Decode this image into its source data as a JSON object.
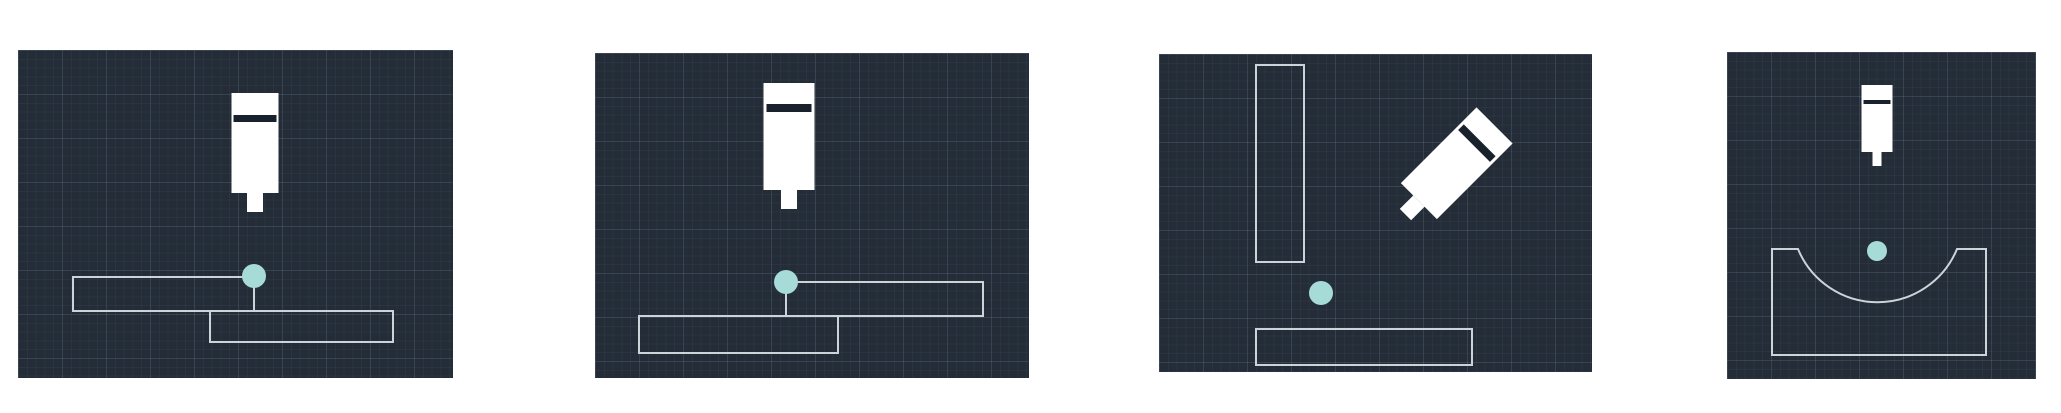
{
  "page": {
    "background": "#ffffff",
    "description_tag": "weld-scenario-thumbnails"
  },
  "theme": {
    "panel_bg": "#232c37",
    "grid_minor": "rgba(148,170,197,0.06)",
    "grid_major": "rgba(148,170,197,0.13)",
    "grid_minor_step": 8.8,
    "grid_major_step": 44,
    "outline": "#ccd3d9",
    "outline_width": 2,
    "dot_fill": "#a6dbd8",
    "torch_fill": "#ffffff",
    "torch_band": "#19222c"
  },
  "panels": [
    {
      "name": "lap-joint-upper-left",
      "x": 18,
      "y": 50,
      "w": 435,
      "h": 328,
      "torch": {
        "cx": 237,
        "top": 43,
        "body_w": 47,
        "body_h": 100,
        "band_offset": 22,
        "band_h": 7,
        "band_inset": 2,
        "stem_w": 16,
        "stem_h": 19,
        "rotation": 0
      },
      "dot": {
        "cx": 236,
        "cy": 226,
        "r": 12
      },
      "shapes": [
        {
          "type": "rect",
          "x": 55,
          "y": 227,
          "w": 181,
          "h": 34
        },
        {
          "type": "rect",
          "x": 192,
          "y": 261,
          "w": 183,
          "h": 31
        }
      ]
    },
    {
      "name": "lap-joint-upper-right",
      "x": 595,
      "y": 53,
      "w": 434,
      "h": 325,
      "torch": {
        "cx": 194,
        "top": 30,
        "body_w": 51,
        "body_h": 107,
        "band_offset": 21,
        "band_h": 8,
        "band_inset": 3,
        "stem_w": 16,
        "stem_h": 19,
        "rotation": 0
      },
      "dot": {
        "cx": 191,
        "cy": 229,
        "r": 12
      },
      "shapes": [
        {
          "type": "rect",
          "x": 191,
          "y": 229,
          "w": 197,
          "h": 34
        },
        {
          "type": "rect",
          "x": 44,
          "y": 263,
          "w": 199,
          "h": 37
        }
      ]
    },
    {
      "name": "corner-joint-angled-torch",
      "x": 1159,
      "y": 54,
      "w": 433,
      "h": 318,
      "torch": {
        "cx": 291,
        "top": 53,
        "body_w": 51,
        "body_h": 107,
        "band_offset": 21,
        "band_h": 8,
        "band_inset": 3,
        "stem_w": 16,
        "stem_h": 19,
        "rotation": 45
      },
      "dot": {
        "cx": 162,
        "cy": 239,
        "r": 12
      },
      "shapes": [
        {
          "type": "rect",
          "x": 97,
          "y": 11,
          "w": 48,
          "h": 197
        },
        {
          "type": "rect",
          "x": 97,
          "y": 275,
          "w": 216,
          "h": 36
        }
      ]
    },
    {
      "name": "concave-groove-joint",
      "x": 1727,
      "y": 52,
      "w": 309,
      "h": 327,
      "torch": {
        "cx": 150,
        "top": 33,
        "body_w": 31,
        "body_h": 67,
        "band_offset": 15,
        "band_h": 4,
        "band_inset": 2,
        "stem_w": 9,
        "stem_h": 14,
        "rotation": 0
      },
      "dot": {
        "cx": 150,
        "cy": 199,
        "r": 10
      },
      "shapes": [
        {
          "type": "path",
          "d": "M 45 197 L 71 197 A 86 86 0 0 0 230 197 L 259 197 L 259 303 L 45 303 Z"
        }
      ]
    }
  ]
}
